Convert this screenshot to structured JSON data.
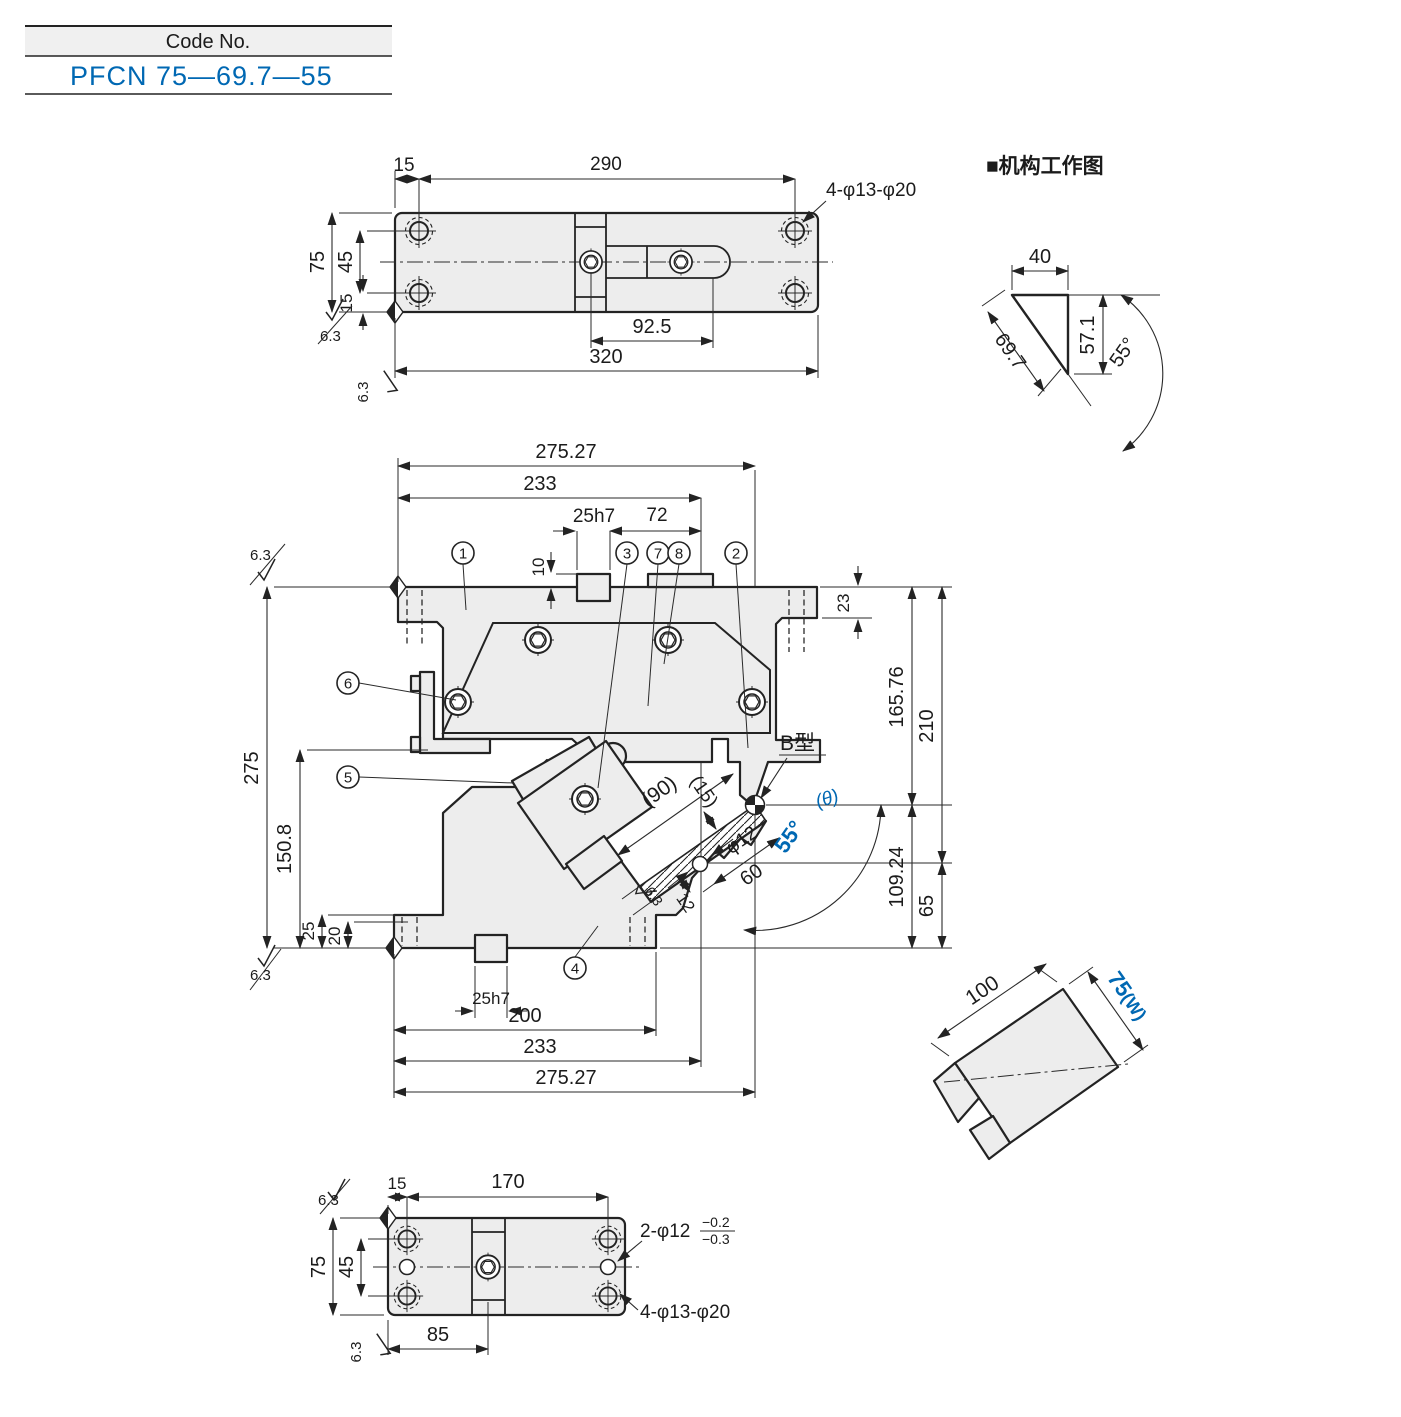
{
  "code_block": {
    "header_label": "Code No.",
    "part_code": "PFCN 75—69.7—55"
  },
  "colors": {
    "accent_blue": "#0068b3",
    "line": "#232323",
    "body_fill": "#ededed"
  },
  "top_view": {
    "dim_15_top": "15",
    "dim_290": "290",
    "dim_75": "75",
    "dim_45": "45",
    "dim_15_side": "15",
    "dim_92_5": "92.5",
    "dim_320": "320",
    "label_holes": "4-φ13-φ20",
    "finish": "6.3"
  },
  "mech": {
    "title": "■机构工作图",
    "dim_40": "40",
    "dim_69_7": "69.7",
    "dim_57_1": "57.1",
    "dim_55": "55°"
  },
  "main_view": {
    "dim_275_27_top": "275.27",
    "dim_233_top": "233",
    "dim_25h7_top": "25h7",
    "dim_72": "72",
    "dim_10": "10",
    "dim_23": "23",
    "dim_165_76": "165.76",
    "dim_210": "210",
    "dim_109_24": "109.24",
    "dim_65": "65",
    "dim_275": "275",
    "dim_150_8": "150.8",
    "dim_25": "25",
    "dim_20": "20",
    "dim_25h7_bottom": "25h7",
    "dim_200": "200",
    "dim_233_bottom": "233",
    "dim_275_27_bottom": "275.27",
    "dim_90": "(90)",
    "dim_15_work": "(15)",
    "dim_phi12": "φ12",
    "dim_12": "12",
    "dim_60": "60",
    "angle_55": "55°",
    "theta": "(θ)",
    "label_b_type": "B型",
    "finish": "6.3",
    "balloons": {
      "b1": "1",
      "b2": "2",
      "b3": "3",
      "b4": "4",
      "b5": "5",
      "b6": "6",
      "b7": "7",
      "b8": "8"
    }
  },
  "iso_view": {
    "dim_100": "100",
    "dim_75": "75",
    "dim_w": "(W)"
  },
  "bottom_view": {
    "dim_15": "15",
    "dim_170": "170",
    "dim_75": "75",
    "dim_45": "45",
    "dim_85": "85",
    "label_phi12": "2-φ12",
    "tol_upper": "−0.2",
    "tol_lower": "−0.3",
    "label_holes": "4-φ13-φ20",
    "finish": "6.3"
  }
}
